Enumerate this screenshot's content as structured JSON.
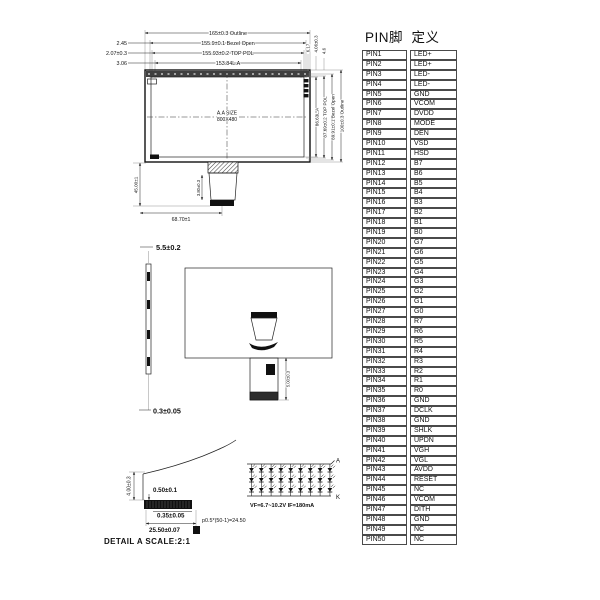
{
  "pin_table": {
    "header": "PIN脚  定义",
    "rows": [
      [
        "PIN1",
        "LED+"
      ],
      [
        "PIN2",
        "LED+"
      ],
      [
        "PIN3",
        "LED-"
      ],
      [
        "PIN4",
        "LED-"
      ],
      [
        "PIN5",
        "GND"
      ],
      [
        "PIN6",
        "VCOM"
      ],
      [
        "PIN7",
        "DVDD"
      ],
      [
        "PIN8",
        "MODE"
      ],
      [
        "PIN9",
        "DEN"
      ],
      [
        "PIN10",
        "VSD"
      ],
      [
        "PIN11",
        "HSD"
      ],
      [
        "PIN12",
        "B7"
      ],
      [
        "PIN13",
        "B6"
      ],
      [
        "PIN14",
        "B5"
      ],
      [
        "PIN15",
        "B4"
      ],
      [
        "PIN16",
        "B3"
      ],
      [
        "PIN17",
        "B2"
      ],
      [
        "PIN18",
        "B1"
      ],
      [
        "PIN19",
        "B0"
      ],
      [
        "PIN20",
        "G7"
      ],
      [
        "PIN21",
        "G6"
      ],
      [
        "PIN22",
        "G5"
      ],
      [
        "PIN23",
        "G4"
      ],
      [
        "PIN24",
        "G3"
      ],
      [
        "PIN25",
        "G2"
      ],
      [
        "PIN26",
        "G1"
      ],
      [
        "PIN27",
        "G0"
      ],
      [
        "PIN28",
        "R7"
      ],
      [
        "PIN29",
        "R6"
      ],
      [
        "PIN30",
        "R5"
      ],
      [
        "PIN31",
        "R4"
      ],
      [
        "PIN32",
        "R3"
      ],
      [
        "PIN33",
        "R2"
      ],
      [
        "PIN34",
        "R1"
      ],
      [
        "PIN35",
        "R0"
      ],
      [
        "PIN36",
        "GND"
      ],
      [
        "PIN37",
        "DCLK"
      ],
      [
        "PIN38",
        "GND"
      ],
      [
        "PIN39",
        "SHLK"
      ],
      [
        "PIN40",
        "UPDN"
      ],
      [
        "PIN41",
        "VGH"
      ],
      [
        "PIN42",
        "VGL"
      ],
      [
        "PIN43",
        "AVDD"
      ],
      [
        "PIN44",
        "RESET"
      ],
      [
        "PIN45",
        "NC"
      ],
      [
        "PIN46",
        "VCOM"
      ],
      [
        "PIN47",
        "DITH"
      ],
      [
        "PIN48",
        "GND"
      ],
      [
        "PIN49",
        "NC"
      ],
      [
        "PIN50",
        "NC"
      ]
    ]
  },
  "front_view": {
    "dims_top": [
      "165±0.3 Outline",
      "155.9±0.1 Bezel Open",
      "155.93±0.2 TOP POL",
      "153.84L.A"
    ],
    "dims_left": [
      "2.45",
      "2.07±0.3",
      "3.06"
    ],
    "dims_right": [
      "86.63L.A",
      "87.69±0.2 TOP POL",
      "89.91±0.1 Bezel Open",
      "100±0.3 Outline"
    ],
    "dims_right_top": [
      "6.17",
      "4.06±0.3",
      "4.6"
    ],
    "dim_left_height": "45.00±1",
    "dim_bottom_width": "68.70±1",
    "dim_fpc": "3.80±0.3",
    "center_label_line1": "A.A SIZE",
    "center_label_line2": "800X480"
  },
  "back_view": {
    "dim_thickness": "5.5±0.2",
    "dim_bottom": "0.3±0.05",
    "dim_fpc": "5.00±0.3"
  },
  "detail_a": {
    "dim_height": "4.00±0.3",
    "dim_finger_top": "0.50±0.1",
    "dim_finger_bottom": "0.35±0.05",
    "dim_width": "25.50±0.07",
    "pitch_formula": "p0.5*(50-1)=24.50",
    "title": "DETAIL A  SCALE:2:1"
  },
  "led_circuit": {
    "anode_label": "A",
    "cathode_label": "K",
    "spec": "VF=6.7~10.2V  IF=180mA",
    "rows": 3,
    "cols": 9
  }
}
